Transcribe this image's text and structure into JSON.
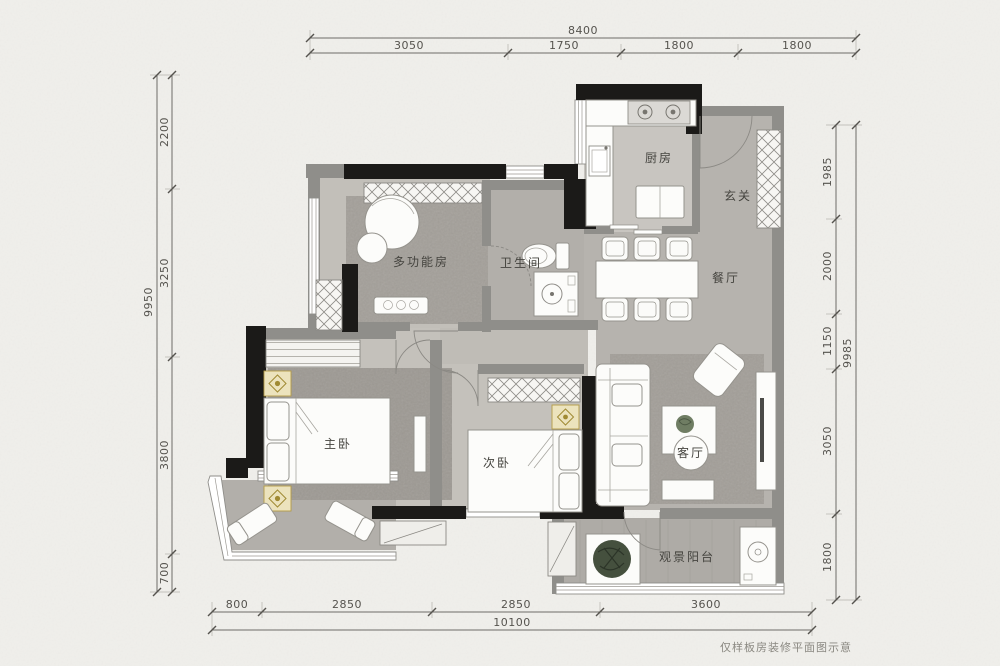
{
  "meta": {
    "footer_note": "仅样板房装修平面图示意",
    "type_label": "apartment floor plan"
  },
  "colors": {
    "paper": "#f0efeb",
    "wall_black": "#1b1a18",
    "wall_gray": "#8f8e8a",
    "floor_light": "#c6c3be",
    "floor_mid": "#b7b4af",
    "rug": "#a19d97",
    "accent_gold": "#a98f36",
    "plant_green": "#45503e"
  },
  "rooms": {
    "kitchen": "厨房",
    "foyer": "玄关",
    "bathroom": "卫生间",
    "dining": "餐厅",
    "multi": "多功能房",
    "master": "主卧",
    "second": "次卧",
    "living": "客厅",
    "balcony": "观景阳台"
  },
  "dimensions": {
    "top": {
      "total": "8400",
      "segments": [
        "3050",
        "1750",
        "1800",
        "1800"
      ]
    },
    "left": {
      "total": "9950",
      "segments": [
        "2200",
        "3250",
        "3800",
        "700"
      ]
    },
    "right": {
      "total": "9985",
      "segments": [
        "1985",
        "2000",
        "1150",
        "3050",
        "1800"
      ]
    },
    "bottom": {
      "total": "10100",
      "segments": [
        "800",
        "2850",
        "2850",
        "3600"
      ]
    }
  },
  "icons": {
    "bed": "bed-icon",
    "sofa": "sofa-icon",
    "dining_table": "dining-table-icon",
    "toilet": "toilet-icon",
    "sink": "sink-icon",
    "stove": "stove-icon",
    "fridge": "fridge-icon",
    "plant": "plant-icon",
    "washer": "washer-icon",
    "lounge_chair": "lounge-chair-icon",
    "wardrobe": "wardrobe-icon",
    "nightstand": "nightstand-icon"
  }
}
